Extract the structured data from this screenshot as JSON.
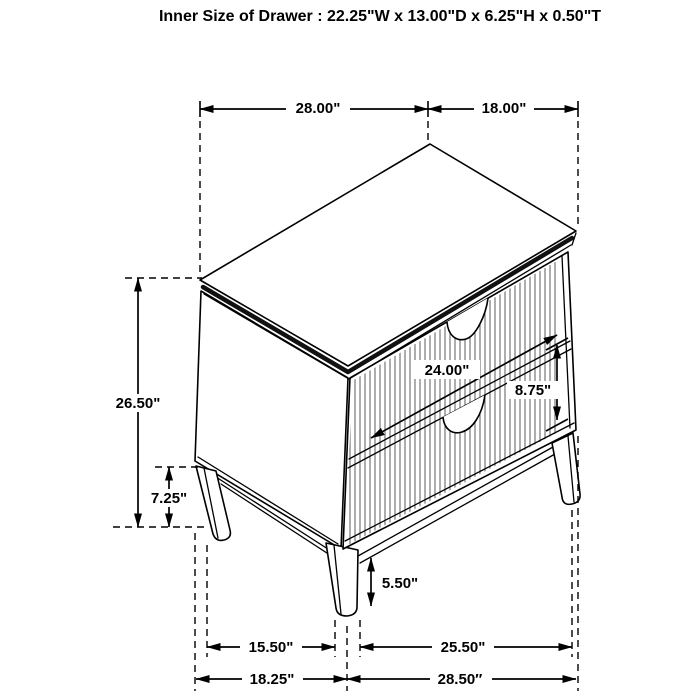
{
  "title": "Inner Size of Drawer : 22.25\"W x 13.00\"D x 6.25\"H x 0.50\"T",
  "dimensions": {
    "top_width": "28.00\"",
    "top_depth": "18.00\"",
    "overall_height": "26.50\"",
    "side_leg_height": "7.25\"",
    "drawer_width": "24.00\"",
    "drawer_front_height": "8.75\"",
    "front_leg_height": "5.50\"",
    "base_width_inner": "15.50\"",
    "base_depth_inner": "25.50\"",
    "base_width_outer": "18.25\"",
    "base_depth_outer": "28.50″"
  }
}
